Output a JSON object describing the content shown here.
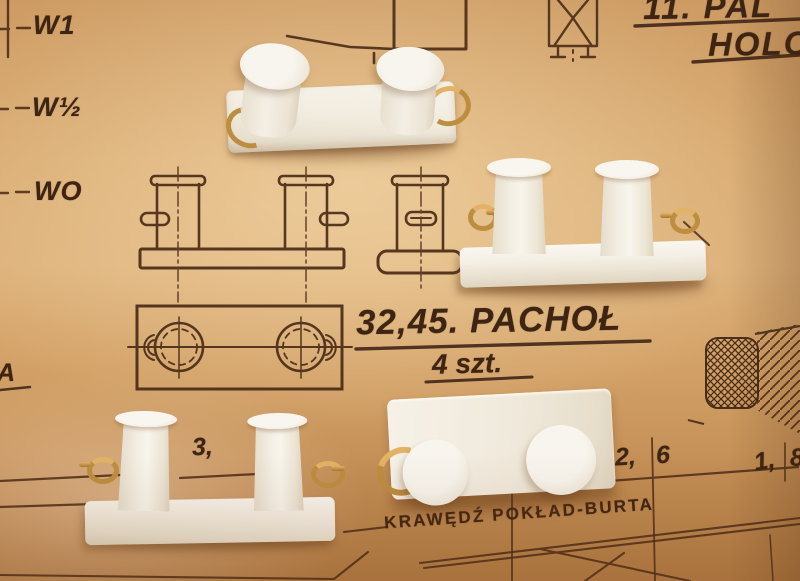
{
  "scene": {
    "description": "Photograph of a Polish ship-model plan sheet with four white bollard castings lying on it",
    "paper_color": "#d8a96f",
    "ink_color": "#4a2b16",
    "part_color": "#f2ece0",
    "brass_color": "#bd8d40"
  },
  "plan": {
    "waterline_labels": {
      "w1": "W1",
      "w_half": "W½",
      "w0": "WO"
    },
    "left_edge_label": "A",
    "title_block": {
      "part_ref": "32,45. PACHOŁ",
      "quantity": "4 szt."
    },
    "corner_note": {
      "line1": "11. PAL",
      "line2": "HOLO"
    },
    "deck_edge_label": "KRAWĘDŹ POKŁAD-BURTA",
    "dimension_marks": {
      "m1": "3,",
      "m2": "2,",
      "m3": "6",
      "m4": "1,",
      "m5": "8"
    }
  },
  "parts": {
    "description": "white double-bollard castings with brass eyelets",
    "count": 4
  }
}
